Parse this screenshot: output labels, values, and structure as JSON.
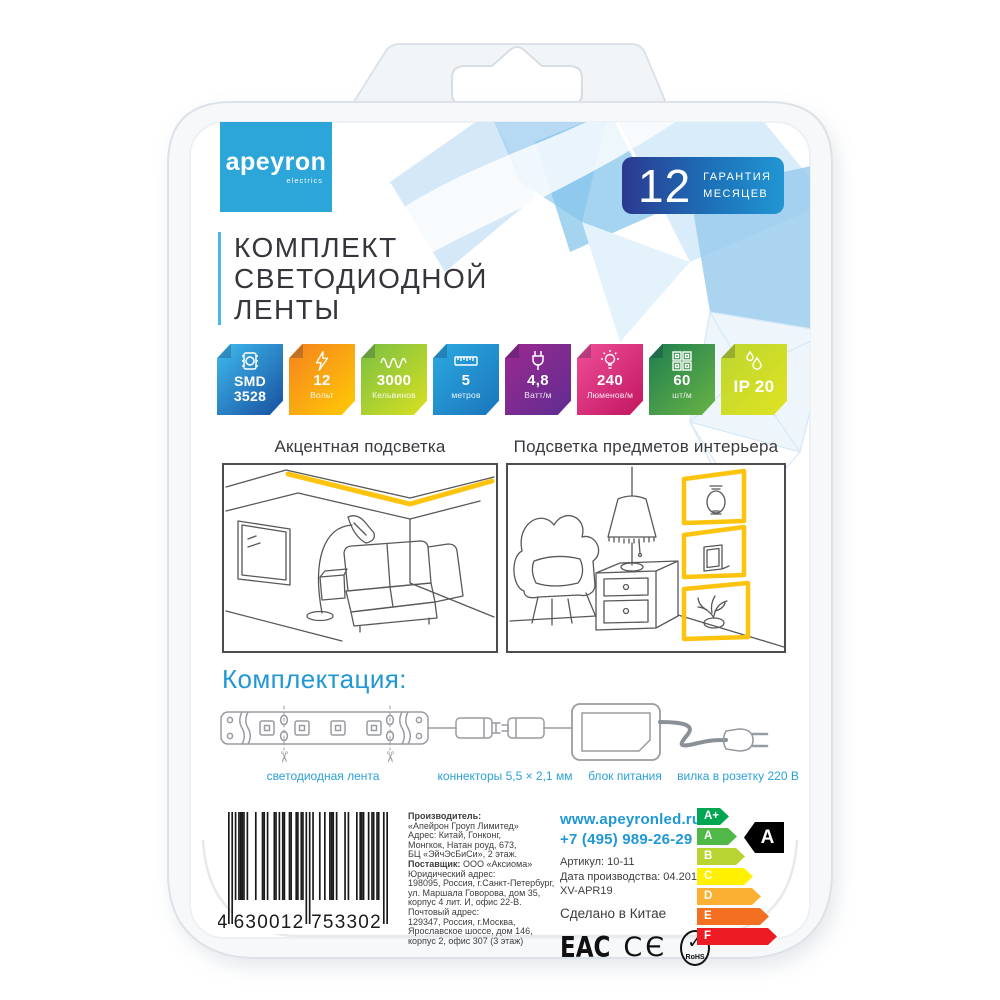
{
  "brand": {
    "logo_text": "apeyron",
    "logo_sub": "electrics"
  },
  "warranty": {
    "number": "12",
    "line1": "ГАРАНТИЯ",
    "line2": "МЕСЯЦЕВ"
  },
  "title": {
    "lines": [
      "КОМПЛЕКТ",
      "СВЕТОДИОДНОЙ",
      "ЛЕНТЫ"
    ]
  },
  "features": [
    {
      "icon": "chip-icon",
      "value_lines": [
        "SMD",
        "3528"
      ],
      "label": "",
      "c1": "#3fbcee",
      "c2": "#174f9f"
    },
    {
      "icon": "lightning-icon",
      "value_lines": [
        "12"
      ],
      "label": "Вольт",
      "c1": "#f5821f",
      "c2": "#ffcb05"
    },
    {
      "icon": "wave-icon",
      "value_lines": [
        "3000"
      ],
      "label": "Кельвинов",
      "c1": "#79bf43",
      "c2": "#d9e021"
    },
    {
      "icon": "ruler-icon",
      "value_lines": [
        "5"
      ],
      "label": "метров",
      "c1": "#2caae1",
      "c2": "#1a75bb"
    },
    {
      "icon": "plug-icon",
      "value_lines": [
        "4,8"
      ],
      "label": "Ватт/м",
      "c1": "#9b2a90",
      "c2": "#5f2c91"
    },
    {
      "icon": "bulb-icon",
      "value_lines": [
        "240"
      ],
      "label": "Люменов/м",
      "c1": "#ee4f98",
      "c2": "#c21560"
    },
    {
      "icon": "led-grid-icon",
      "value_lines": [
        "60"
      ],
      "label": "шт/м",
      "c1": "#1e7e4f",
      "c2": "#69b345"
    },
    {
      "icon": "drops-icon",
      "value_lines": [
        "IP 20"
      ],
      "label": "",
      "c1": "#bcd631",
      "c2": "#e0e321"
    }
  ],
  "scenes": {
    "left_caption": "Акцентная подсветка",
    "right_caption": "Подсветка предметов интерьера"
  },
  "kit": {
    "heading": "Комплектация:",
    "labels": [
      "светодиодная лента",
      "коннекторы 5,5 × 2,1 мм",
      "блок питания",
      "вилка в розетку 220 В"
    ]
  },
  "manufacturer": {
    "lines": [
      {
        "b": "Производитель:",
        "t": ""
      },
      {
        "b": "",
        "t": "«Апейрон Гроуп Лимитед»"
      },
      {
        "b": "",
        "t": "Адрес: Китай, Гонконг,"
      },
      {
        "b": "",
        "t": "Монгкок, Натан роуд, 673,"
      },
      {
        "b": "",
        "t": "БЦ «ЭйчЭсБиСи», 2 этаж."
      },
      {
        "b": "Поставщик:",
        "t": " ООО «Аксиома»"
      },
      {
        "b": "",
        "t": "Юридический адрес:"
      },
      {
        "b": "",
        "t": "198095, Россия, г.Санкт-Петербург,"
      },
      {
        "b": "",
        "t": "ул. Маршала Говорова, дом 35,"
      },
      {
        "b": "",
        "t": "корпус 4 лит. И, офис 22-В."
      },
      {
        "b": "",
        "t": "Почтовый адрес:"
      },
      {
        "b": "",
        "t": "129347, Россия, г.Москва,"
      },
      {
        "b": "",
        "t": "Ярославское шоссе, дом 146,"
      },
      {
        "b": "",
        "t": "корпус 2, офис 307 (3 этаж)"
      }
    ]
  },
  "contacts": {
    "website": "www.apeyronled.ru",
    "phone": "+7 (495) 989-26-29",
    "sku": "Артикул: 10-11",
    "production_date": "Дата производства: 04.2019",
    "batch": "XV-APR19",
    "made_in": "Сделано в Китае"
  },
  "certifications": {
    "eac": "ЕАС",
    "ce": "CЄ",
    "rohs_check": "✓",
    "rohs": "RoHS"
  },
  "energy": {
    "selected": "A",
    "rows": [
      {
        "label": "A+",
        "color": "#00a651"
      },
      {
        "label": "A",
        "color": "#50b848"
      },
      {
        "label": "B",
        "color": "#b8d433"
      },
      {
        "label": "C",
        "color": "#fff100"
      },
      {
        "label": "D",
        "color": "#fbb034"
      },
      {
        "label": "E",
        "color": "#f36f21"
      },
      {
        "label": "F",
        "color": "#ed1c24"
      }
    ]
  },
  "barcode": {
    "value": "4630012753302"
  }
}
